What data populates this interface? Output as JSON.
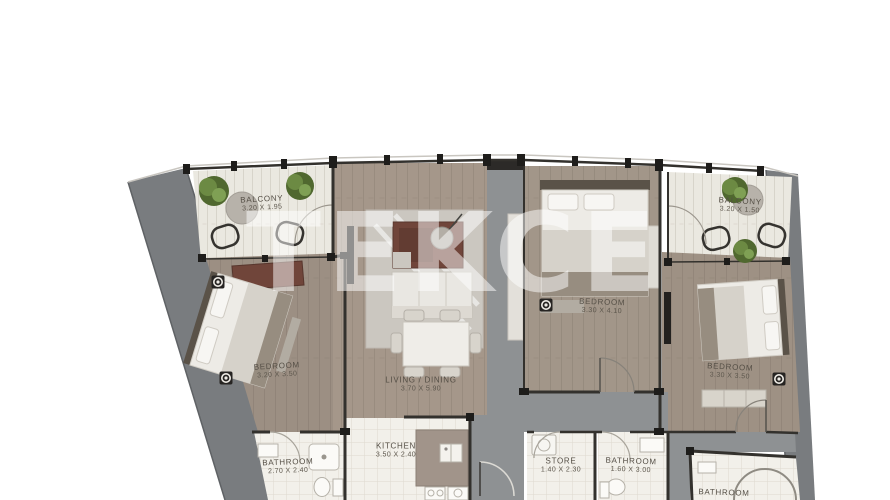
{
  "watermark": "TEKCE",
  "plan": {
    "rooms": [
      {
        "id": "balcony-left",
        "name": "BALCONY",
        "dims": "3.20 X 1.95"
      },
      {
        "id": "balcony-right",
        "name": "BALCONY",
        "dims": "3.20 X 1.50"
      },
      {
        "id": "bedroom-left",
        "name": "BEDROOM",
        "dims": "3.20 X 3.50"
      },
      {
        "id": "living-dining",
        "name": "LIVING / DINING",
        "dims": "3.70 X 5.90"
      },
      {
        "id": "bedroom-middle",
        "name": "BEDROOM",
        "dims": "3.30 X 4.10"
      },
      {
        "id": "bedroom-right",
        "name": "BEDROOM",
        "dims": "3.30 X 3.50"
      },
      {
        "id": "bathroom-left",
        "name": "BATHROOM",
        "dims": "2.70 X 2.40"
      },
      {
        "id": "kitchen",
        "name": "KITCHEN",
        "dims": "3.50 X 2.40"
      },
      {
        "id": "store",
        "name": "STORE",
        "dims": "1.40 X 2.30"
      },
      {
        "id": "bathroom-middle",
        "name": "BATHROOM",
        "dims": "1.60 X 3.00"
      },
      {
        "id": "bathroom-right",
        "name": "BATHROOM",
        "dims": ""
      }
    ],
    "colors": {
      "wall": "#33312d",
      "living_floor": "#a5978a",
      "bedroom_floor": "#9c8f83",
      "balcony_floor": "#eae8e0",
      "tile_floor": "#f2f0ea",
      "core_gray": "#8e9193",
      "facade_gray": "#797c7f",
      "accent_red": "#70453a",
      "plant_green": "#50682f",
      "label_text": "#554f46"
    }
  }
}
